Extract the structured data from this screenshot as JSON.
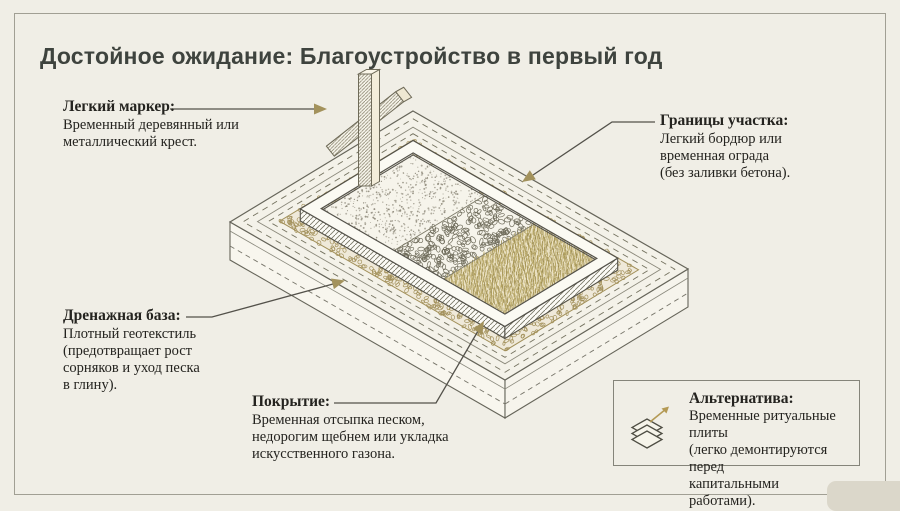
{
  "title": "Достойное ожидание: Благоустройство в первый год",
  "callouts": {
    "marker": {
      "heading": "Легкий маркер:",
      "body": "Временный деревянный или\nметаллический крест."
    },
    "borders": {
      "heading": "Границы участка:",
      "body": "Легкий бордюр или\nвременная ограда\n(без заливки бетона)."
    },
    "drainage": {
      "heading": "Дренажная база:",
      "body": "Плотный геотекстиль\n(предотвращает рост\nсорняков и уход песка\nв глину)."
    },
    "cover": {
      "heading": "Покрытие:",
      "body": "Временная отсыпка песком,\nнедорогим щебнем или укладка\nискусственного газона."
    }
  },
  "alt_box": {
    "heading": "Альтернатива:",
    "body": "Временные ритуальные плиты\n(легко демонтируются перед\nкапитальными работами)."
  },
  "colors": {
    "background": "#f0eee6",
    "frame_border": "#a19f94",
    "title_text": "#3e433e",
    "body_text": "#24231f",
    "leader_line": "#53514a",
    "arrow_gold": "#a3925c",
    "gravel_gold": "#a2905a",
    "grass_bg": "#eae1c3",
    "grass_blade": "#b2a15e",
    "curb_white": "#fbfaf3",
    "platform_white": "#f4f2e9"
  }
}
